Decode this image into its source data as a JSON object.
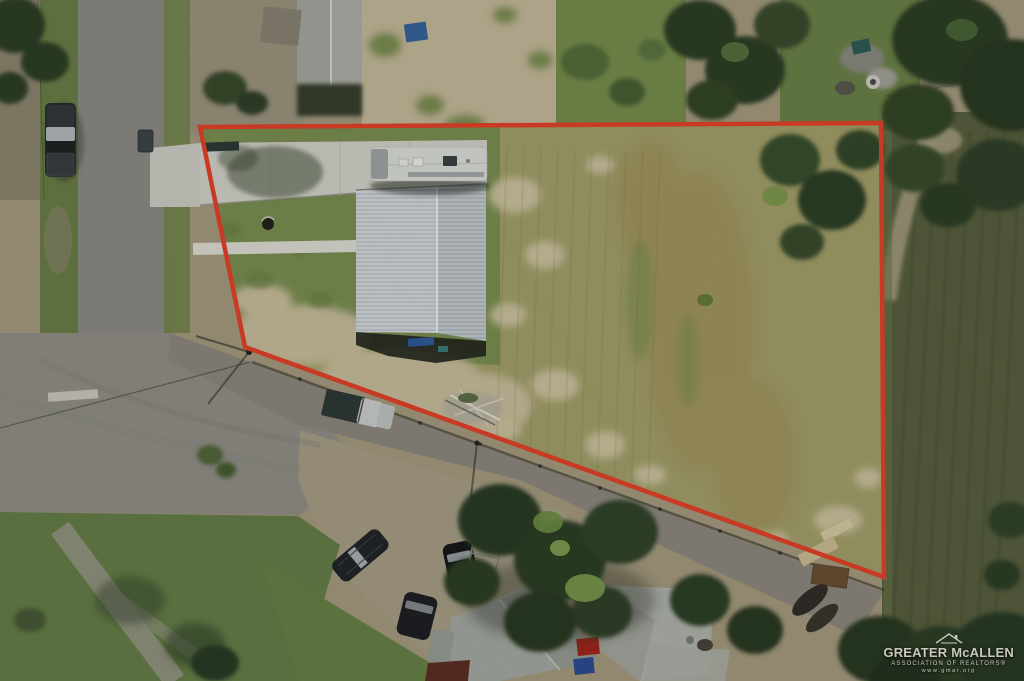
{
  "watermark": {
    "org_name": "GREATER McALLEN",
    "tagline": "ASSOCIATION OF REALTORS®",
    "website": "www.gmar.org",
    "logo": "roof-outline-icon",
    "text_color": "#d8d3c9"
  },
  "annotation": {
    "label": "property-boundary-outline",
    "boundary_points": "200,127 881,123 884,577 245,347",
    "boundary_color": "#e8432a",
    "boundary_width": 4.5
  },
  "scene": {
    "type": "aerial-drone-photo-of-vacant-lot",
    "palette": {
      "lot_field": "#a6a26c",
      "lot_grass": "#7d9253",
      "sandy_soil": "#ccc09f",
      "asphalt_road": "#8f8d86",
      "concrete_driveway": "#d6d5cd",
      "metal_roof_white": "#d9dee1",
      "crop_field_east": "#596140",
      "tree_canopy": "#2e3f26",
      "boundary_red": "#e8432a"
    }
  }
}
